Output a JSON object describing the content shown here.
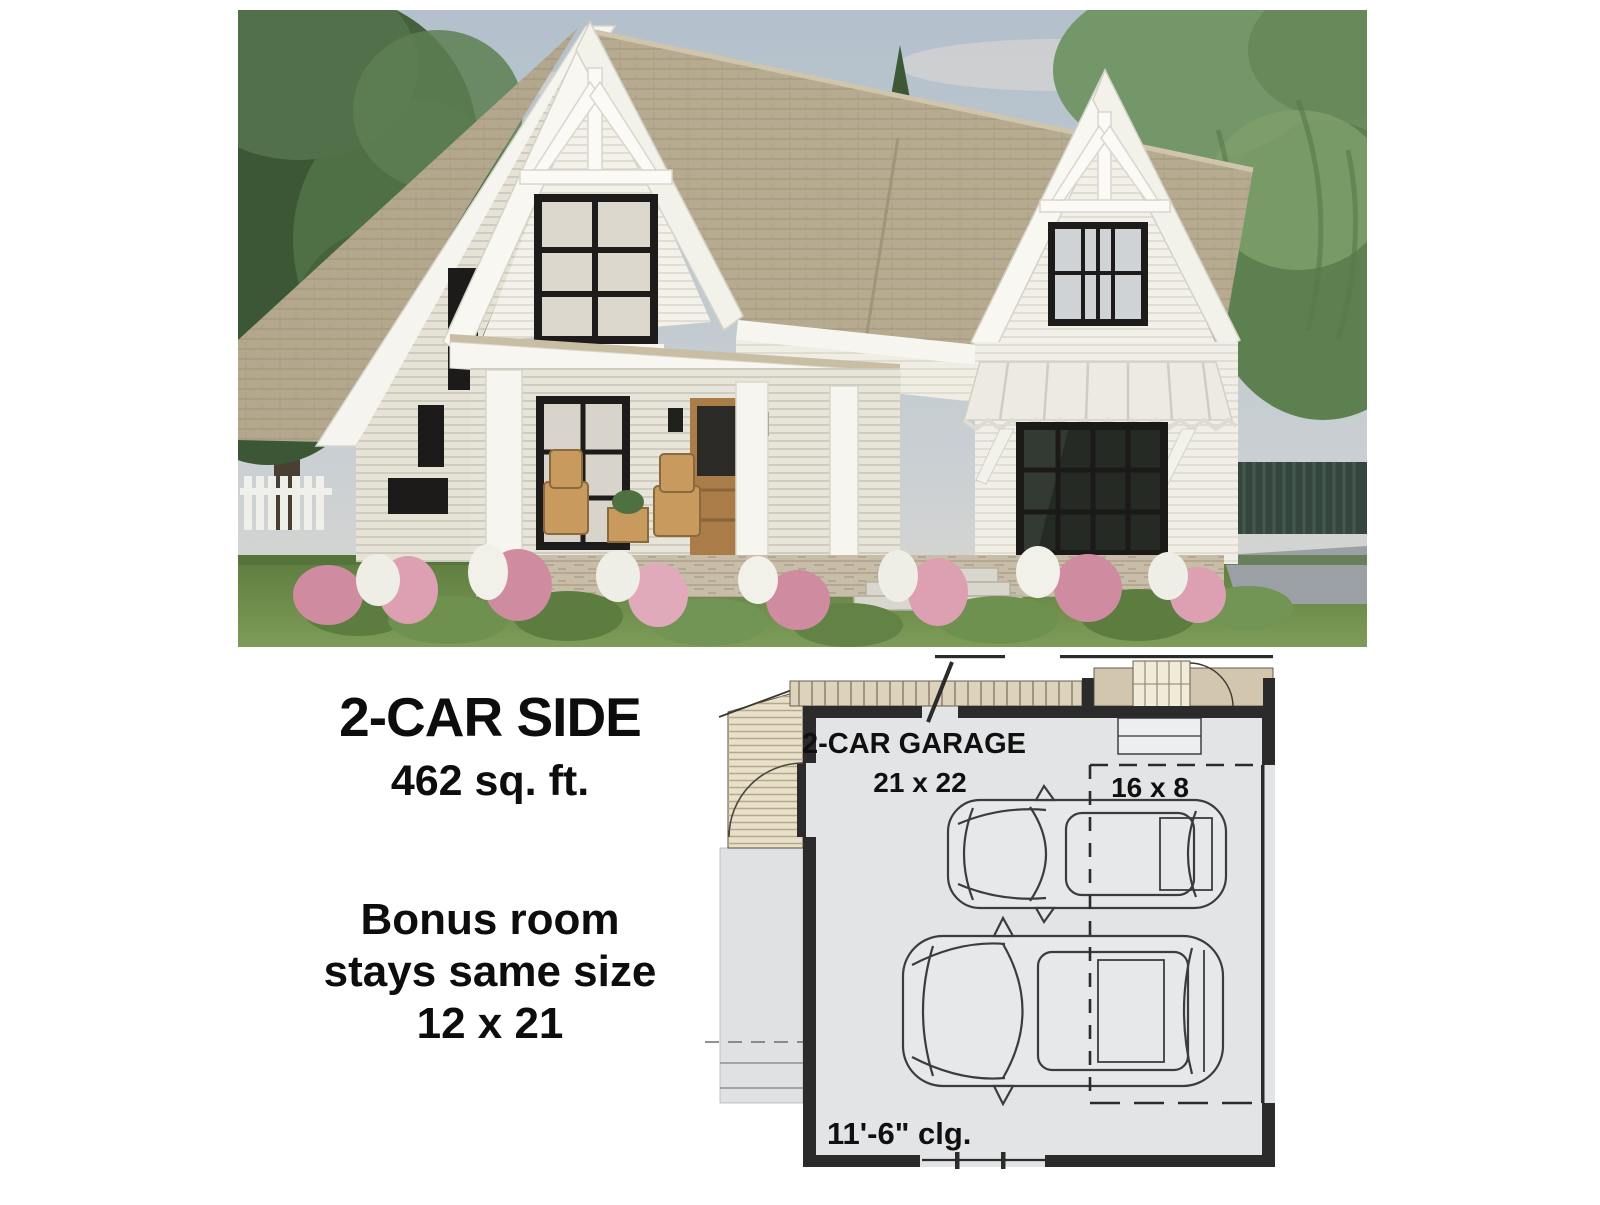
{
  "info_panel": {
    "title": "2-CAR SIDE",
    "area": "462 sq. ft.",
    "note_line1": "Bonus room",
    "note_line2": "stays same size",
    "note_line3": "12 x 21"
  },
  "floor_plan": {
    "room_label": "2-CAR GARAGE",
    "room_dims": "21 x 22",
    "door_dims": "16 x 8",
    "ceiling_height": "11'-6\" clg.",
    "colors": {
      "floor": "#e3e4e6",
      "wall": "#2b2b2b",
      "deck": "#e8e0c9",
      "deck_strip": "#ddd3bc",
      "stairs": "#f0ead8",
      "concrete": "#e0e1e2",
      "car_line": "#3c3c3c"
    }
  },
  "photo": {
    "colors": {
      "sky": "#b9c4cd",
      "roof": "#b4a88e",
      "siding": "#f2f0e8",
      "window_frame": "#1d1b19",
      "door_wood": "#a97c48",
      "awning": "#eceae2",
      "stone_base": "#c6bba7",
      "lawn": "#6f9248",
      "tree_dark": "#44603c",
      "tree_light": "#6a8c5c",
      "flowers_pink": "#d596aa",
      "driveway": "#9aa0a3"
    }
  }
}
